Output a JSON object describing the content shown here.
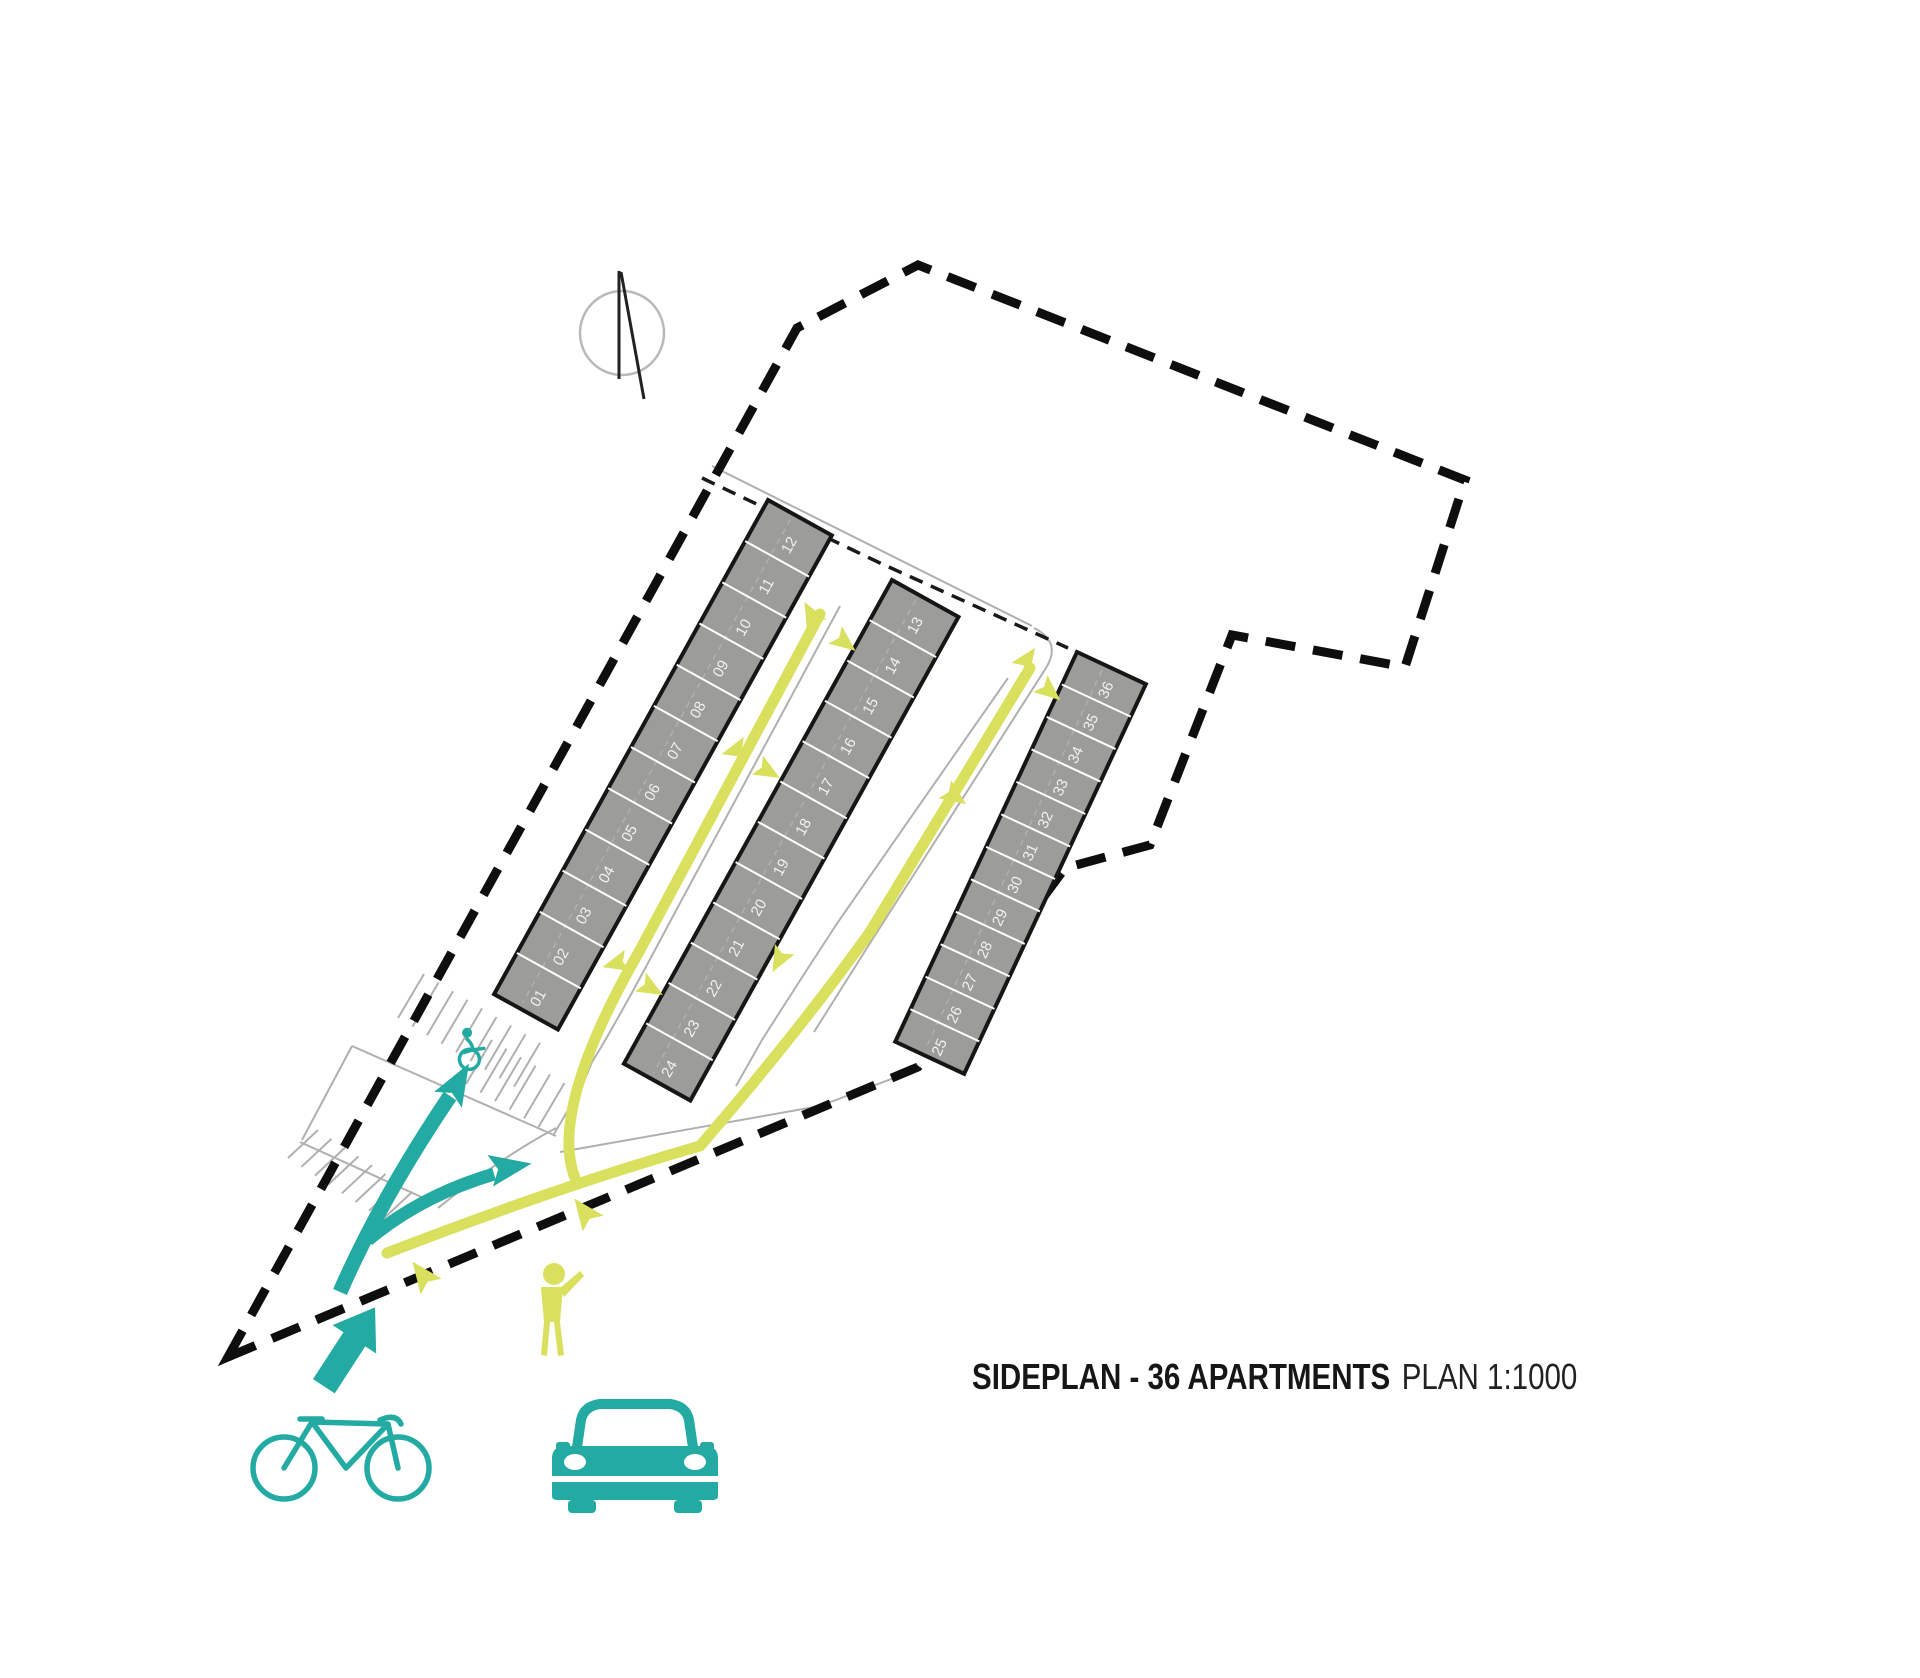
{
  "title": {
    "bold": "SIDEPLAN - 36 APARTMENTS",
    "regular": "PLAN 1:1000"
  },
  "colors": {
    "teal": "#23aaa2",
    "lime": "#d9e05e",
    "building_grey": "#9c9c99",
    "building_border": "#161616",
    "ink": "#0e0e0e",
    "road": "#b0b0af",
    "unit_text": "#f2f2ef",
    "compass_ring": "#b9b9b9"
  },
  "plan": {
    "boundary": "228,1357 797,328 918,265 1465,480 1405,667 1232,635 1150,845 1065,868 918,1067",
    "inner_dashed": "702,478 880,563 1068,648",
    "roads": [
      "M712,466 L1032,626",
      "M1034,628 Q1062,642 1046,668 L872,940 L814,1032",
      "M1008,678 L838,922 Q800,980 762,1040 L736,1086",
      "M840,606 L672,918 Q616,1024 592,1062 L578,1096",
      "M560,1152 L820,1106 L915,1070",
      "M438,1208 Q500,1158 556,1128",
      "M352,1046 L556,1136",
      "M352,1046 L302,1140",
      "M300,1142 L428,1200"
    ],
    "stall_groups": [
      {
        "x": 398,
        "y": 1018,
        "dx": 14.5,
        "dy": 8.6,
        "tx": 26,
        "ty": -44,
        "count": 9
      },
      {
        "x": 466,
        "y": 1084,
        "dx": 14.5,
        "dy": 8.6,
        "tx": 26,
        "ty": -44,
        "count": 7
      },
      {
        "x": 288,
        "y": 1158,
        "dx": 13.5,
        "dy": 8.8,
        "tx": 30,
        "ty": -28,
        "count": 8
      }
    ],
    "buildings": [
      {
        "name": "apartment-block-1",
        "x": 768,
        "y": 500,
        "angle": 29,
        "width": 73,
        "length": 565,
        "units": [
          "12",
          "11",
          "10",
          "09",
          "08",
          "07",
          "06",
          "05",
          "04",
          "03",
          "02",
          "01"
        ]
      },
      {
        "name": "apartment-block-2",
        "x": 892,
        "y": 580,
        "angle": 29,
        "width": 76,
        "length": 553,
        "units": [
          "13",
          "14",
          "15",
          "16",
          "17",
          "18",
          "19",
          "20",
          "21",
          "22",
          "23",
          "24"
        ]
      },
      {
        "name": "apartment-block-3",
        "x": 1077,
        "y": 652,
        "angle": 25,
        "width": 76,
        "length": 430,
        "units": [
          "36",
          "35",
          "34",
          "33",
          "32",
          "31",
          "30",
          "29",
          "28",
          "27",
          "26",
          "25"
        ]
      }
    ],
    "paths": [
      {
        "name": "pedestrian-route-main",
        "d": "M387,1253 Q560,1186 700,1146 Q800,1030 870,932 L1030,668"
      },
      {
        "name": "pedestrian-route-west",
        "d": "M820,614 L640,950 Q548,1110 575,1178"
      }
    ],
    "lime_arrows": [
      {
        "x": 812,
        "y": 616,
        "rot": -118
      },
      {
        "x": 843,
        "y": 641,
        "rot": 38
      },
      {
        "x": 737,
        "y": 750,
        "rot": 165
      },
      {
        "x": 766,
        "y": 770,
        "rot": 30
      },
      {
        "x": 618,
        "y": 963,
        "rot": 165
      },
      {
        "x": 649,
        "y": 987,
        "rot": 30
      },
      {
        "x": 1026,
        "y": 661,
        "rot": -55
      },
      {
        "x": 1048,
        "y": 690,
        "rot": 40
      },
      {
        "x": 953,
        "y": 795,
        "rot": 35
      },
      {
        "x": 780,
        "y": 958,
        "rot": 118
      },
      {
        "x": 424,
        "y": 1277,
        "rot": 233,
        "s": 1.2
      },
      {
        "x": 586,
        "y": 1214,
        "rot": 233,
        "s": 1.2
      }
    ],
    "teal_routes": {
      "route_main": "M340,1292 Q380,1200 450,1096",
      "route_branch": "M368,1240 Q420,1196 494,1174",
      "arrowheads": [
        {
          "x": 456,
          "y": 1086,
          "rot": -60
        },
        {
          "x": 506,
          "y": 1168,
          "rot": -10
        }
      ],
      "entry": {
        "x": 350,
        "y": 1346,
        "rot": -57
      }
    },
    "compass": {
      "cx": 622,
      "cy": 333,
      "r": 42
    },
    "icons": {
      "wheelchair": {
        "x": 466,
        "y": 1052
      },
      "person": {
        "x": 552,
        "y": 1274
      },
      "bicycle": {
        "x": 250,
        "y": 1410
      },
      "car": {
        "x": 548,
        "y": 1396
      }
    }
  }
}
